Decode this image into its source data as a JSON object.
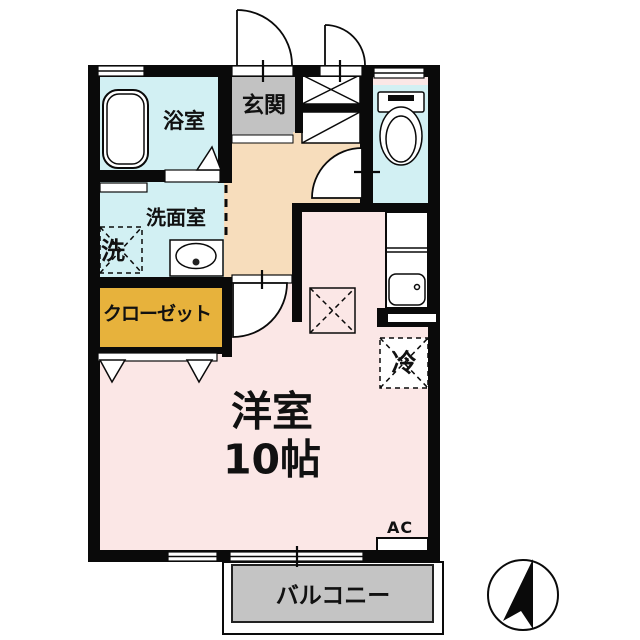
{
  "floorplan": {
    "rooms": {
      "bath": {
        "label": "浴室"
      },
      "entrance": {
        "label": "玄関"
      },
      "washroom": {
        "label": "洗面室"
      },
      "washer_space": {
        "label": "洗"
      },
      "closet": {
        "label": "クローゼット"
      },
      "main_room": {
        "label_line1": "洋室",
        "label_line2": "10帖"
      },
      "refrigerator_space": {
        "label": "冷"
      },
      "air_conditioner": {
        "label": "AC"
      },
      "balcony": {
        "label": "バルコニー"
      }
    },
    "colors": {
      "wet_area_cyan": "#d2f0f3",
      "entrance_gray": "#c2c2c2",
      "hall_tan": "#f7ddbc",
      "room_pink": "#fbe7e6",
      "closet_yellow": "#e7b23c",
      "balcony_gray": "#c4c4c4",
      "wall_black": "#0a0a0a"
    },
    "compass": {
      "icon": "north-arrow",
      "orientation": "up"
    }
  }
}
